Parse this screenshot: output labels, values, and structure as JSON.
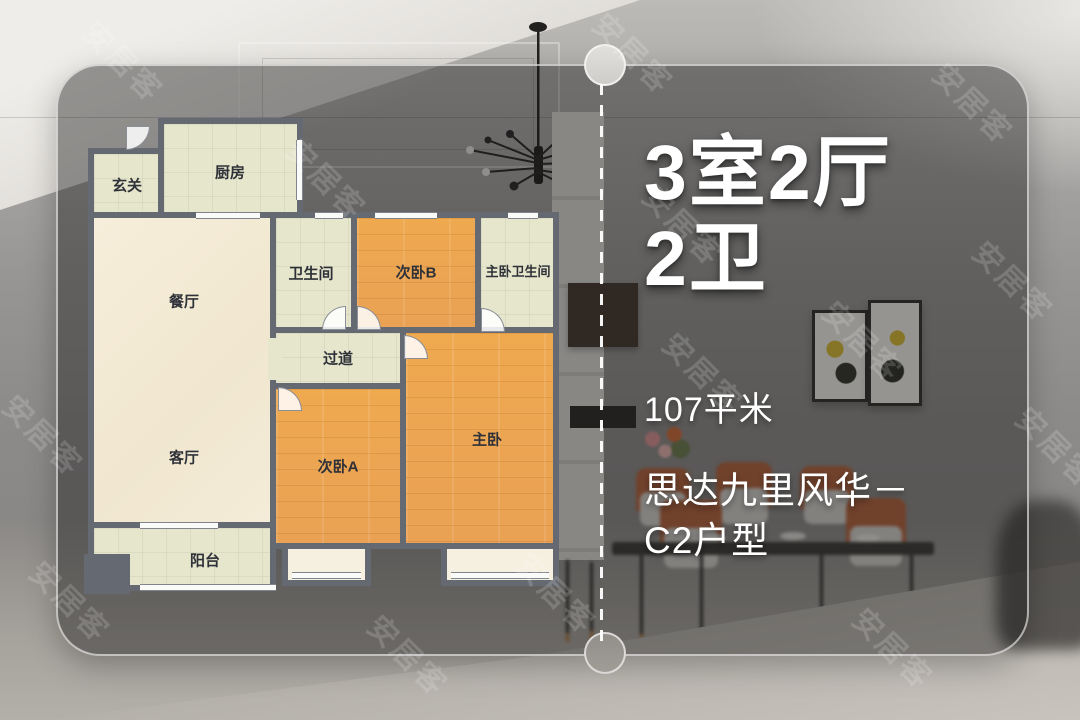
{
  "watermark": {
    "text": "安居客"
  },
  "panel": {
    "layout_title_line1": "3室2厅",
    "layout_title_line2": "2卫",
    "area": "107平米",
    "project_line1": "思达九里风华－",
    "project_line2": "C2户型"
  },
  "floorplan": {
    "rooms": {
      "entry": {
        "label": "玄关"
      },
      "kitchen": {
        "label": "厨房"
      },
      "dining": {
        "label": "餐厅"
      },
      "living": {
        "label": "客厅"
      },
      "balcony": {
        "label": "阳台"
      },
      "bathroom": {
        "label": "卫生间"
      },
      "bedroom_b": {
        "label": "次卧B"
      },
      "master_bathroom": {
        "label": "主卧卫生间"
      },
      "hallway": {
        "label": "过道"
      },
      "bedroom_a": {
        "label": "次卧A"
      },
      "master_bedroom": {
        "label": "主卧"
      }
    }
  },
  "colors": {
    "wall": "#656a72",
    "wood_floor": "#eda551",
    "tile_floor": "#e6e6cd",
    "cream_floor": "#f4ecd8",
    "text_light": "#ffffff"
  }
}
